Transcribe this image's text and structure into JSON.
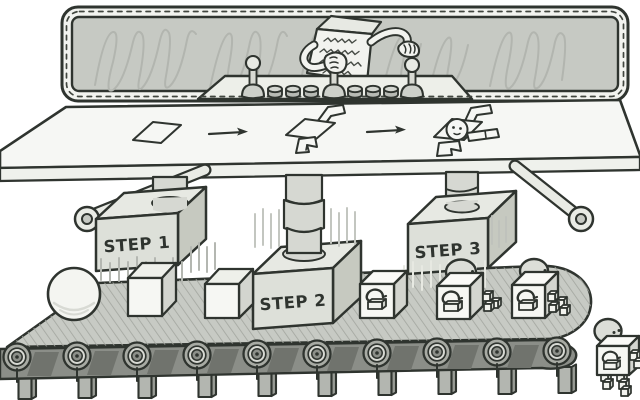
{
  "illustration": {
    "alt": "Cartoon assembly line: a scribble-faced box operator at a windowed control panel turns flat sheets into walking robot boxes via three presses over a conveyor belt",
    "palette": {
      "ink": "#2f342f",
      "paper": "#f6f7f4",
      "glass": "#c6c9c3",
      "machine_light": "#e7e9e3",
      "machine_mid": "#dde0d9",
      "machine_dark": "#c6c9c0",
      "belt_surface": "#c7cac4",
      "belt_band": "#8b8e88"
    },
    "operator": {
      "character": "box-with-scribble-face",
      "station": "stitched-window-control-panel"
    },
    "control_panel": {
      "joystick_count": 3,
      "button_count": 6
    },
    "process_row": {
      "icons": [
        "flat-sheet",
        "arrow-right",
        "half-folded-box",
        "arrow-right",
        "robot-blueprint"
      ]
    },
    "presses": [
      {
        "label": "STEP 1"
      },
      {
        "label": "STEP 2"
      },
      {
        "label": "STEP 3"
      }
    ],
    "conveyor": {
      "roller_count": 10,
      "items": [
        "sphere",
        "blank-cube",
        "blank-cube",
        "printed-box",
        "robot-box-with-head",
        "robot-box-with-head",
        "walking-robot-box"
      ]
    },
    "product_mark": "printer-icon"
  }
}
